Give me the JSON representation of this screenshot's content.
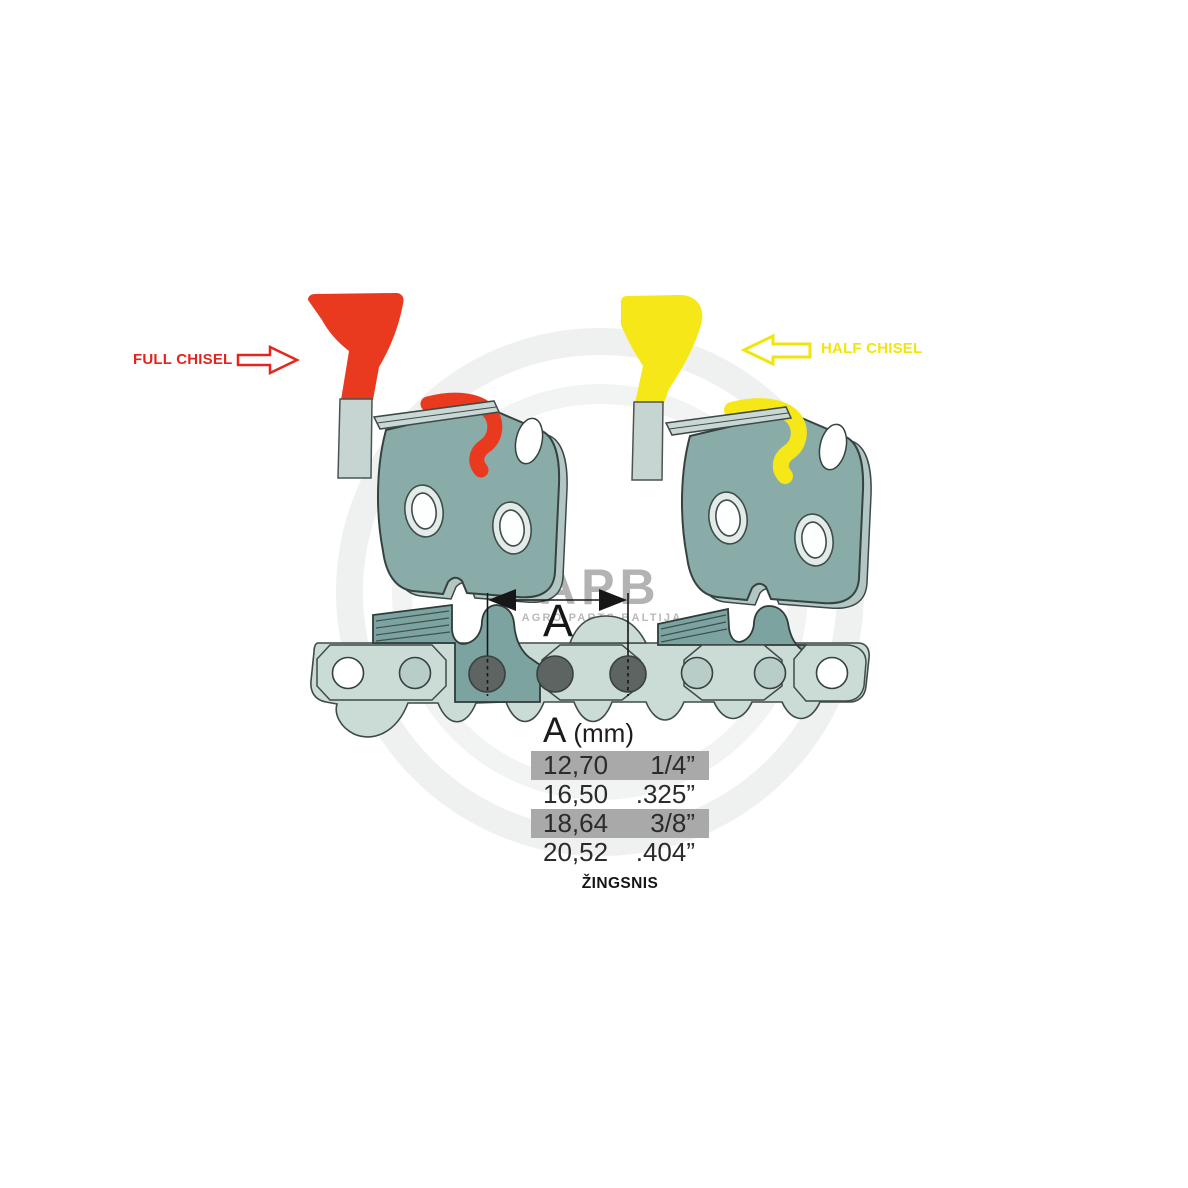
{
  "annotations": {
    "full_chisel": {
      "label": "FULL CHISEL",
      "color": "#e5231d",
      "arrow_direction": "right"
    },
    "half_chisel": {
      "label": "HALF CHISEL",
      "color": "#f3e50c",
      "arrow_direction": "left"
    }
  },
  "dimension": {
    "letter": "A"
  },
  "pitch_table": {
    "header": {
      "letter": "A",
      "unit": "(mm)"
    },
    "rows": [
      {
        "mm": "12,70",
        "inches": "1/4”",
        "highlighted": true
      },
      {
        "mm": "16,50",
        "inches": ".325”",
        "highlighted": false
      },
      {
        "mm": "18,64",
        "inches": "3/8”",
        "highlighted": true
      },
      {
        "mm": "20,52",
        "inches": ".404”",
        "highlighted": false
      }
    ],
    "caption": "ŽINGSNIS"
  },
  "watermark": {
    "brand": "APB",
    "subtitle": "AGRO PARTS BALTIJA"
  },
  "colors": {
    "full_chisel_red": "#e93a20",
    "half_chisel_yellow": "#f6e719",
    "cutter_body_teal": "#8aaca8",
    "chain_strap_teal": "#cbdbd6",
    "chain_cutter_teal": "#7ca39f",
    "rivet_gray": "#5d6462",
    "table_highlight_gray": "#a9a9a9",
    "watermark_gray": "#b3b3b3"
  }
}
